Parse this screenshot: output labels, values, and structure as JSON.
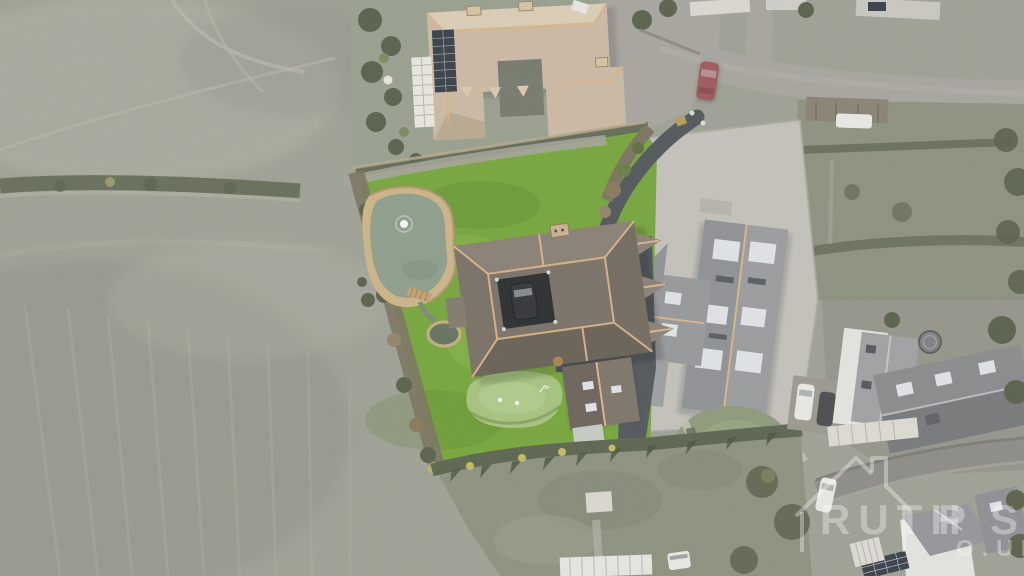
{
  "image": {
    "kind": "aerial-drone-photo",
    "description": "Top-down aerial photograph of a rural property: bright green landscaped garden with ornamental pond, putting green, large hip-roofed house with central courtyard, new tarmac driveway, neighbouring grey-roofed modern house, tan-roofed manor with solar panels to the north, muted grey-green farm fields to the west, village lane and cottages to the east."
  },
  "watermark": {
    "text_fragments": [
      "RUTH",
      "P",
      "S",
      "O.UK"
    ],
    "logo": "house-outline-icon"
  },
  "palette": {
    "field": "#9ea194",
    "fieldlight": "#b6b4a8",
    "fielddark": "#8c9085",
    "lawn": "#77a63d",
    "green2": "#a6c37f",
    "water": "#8f9e8c",
    "sand": "#cdb488",
    "hedge": "#5d6650",
    "scrub": "#7b7460",
    "tree": "#5a624c",
    "roofmain": "#7b7268",
    "ridge": "#d9b489",
    "rooftan": "#cbb9a4",
    "solar": "#3a4048",
    "tarmac": "#53585c",
    "road": "#a7a59e",
    "concrete": "#c3c1ba",
    "roofn": "#9a9c9e",
    "skylight": "#dfe3e5",
    "wall": "#e5e3df",
    "garden": "#8d927f",
    "carred": "#9e5a5c",
    "carwhite": "#e9e8e3",
    "cardark": "#33363a",
    "wm": "rgba(255,255,255,0.34)"
  },
  "features": {
    "pond": "ornamental pond with fountain and footbridge",
    "putting_green": "garden putting green",
    "main_house": "large hip-roof house with inner courtyard and parked car",
    "driveway": "dark fresh tarmac drive",
    "north_house": "tan-roof manor with solar array and conservatory",
    "neighbour_house": "grey-roof modern house with rooflights",
    "red_car": "red car parked on lane",
    "white_van": "white van",
    "fields": "ploughed grey-green farm fields"
  }
}
